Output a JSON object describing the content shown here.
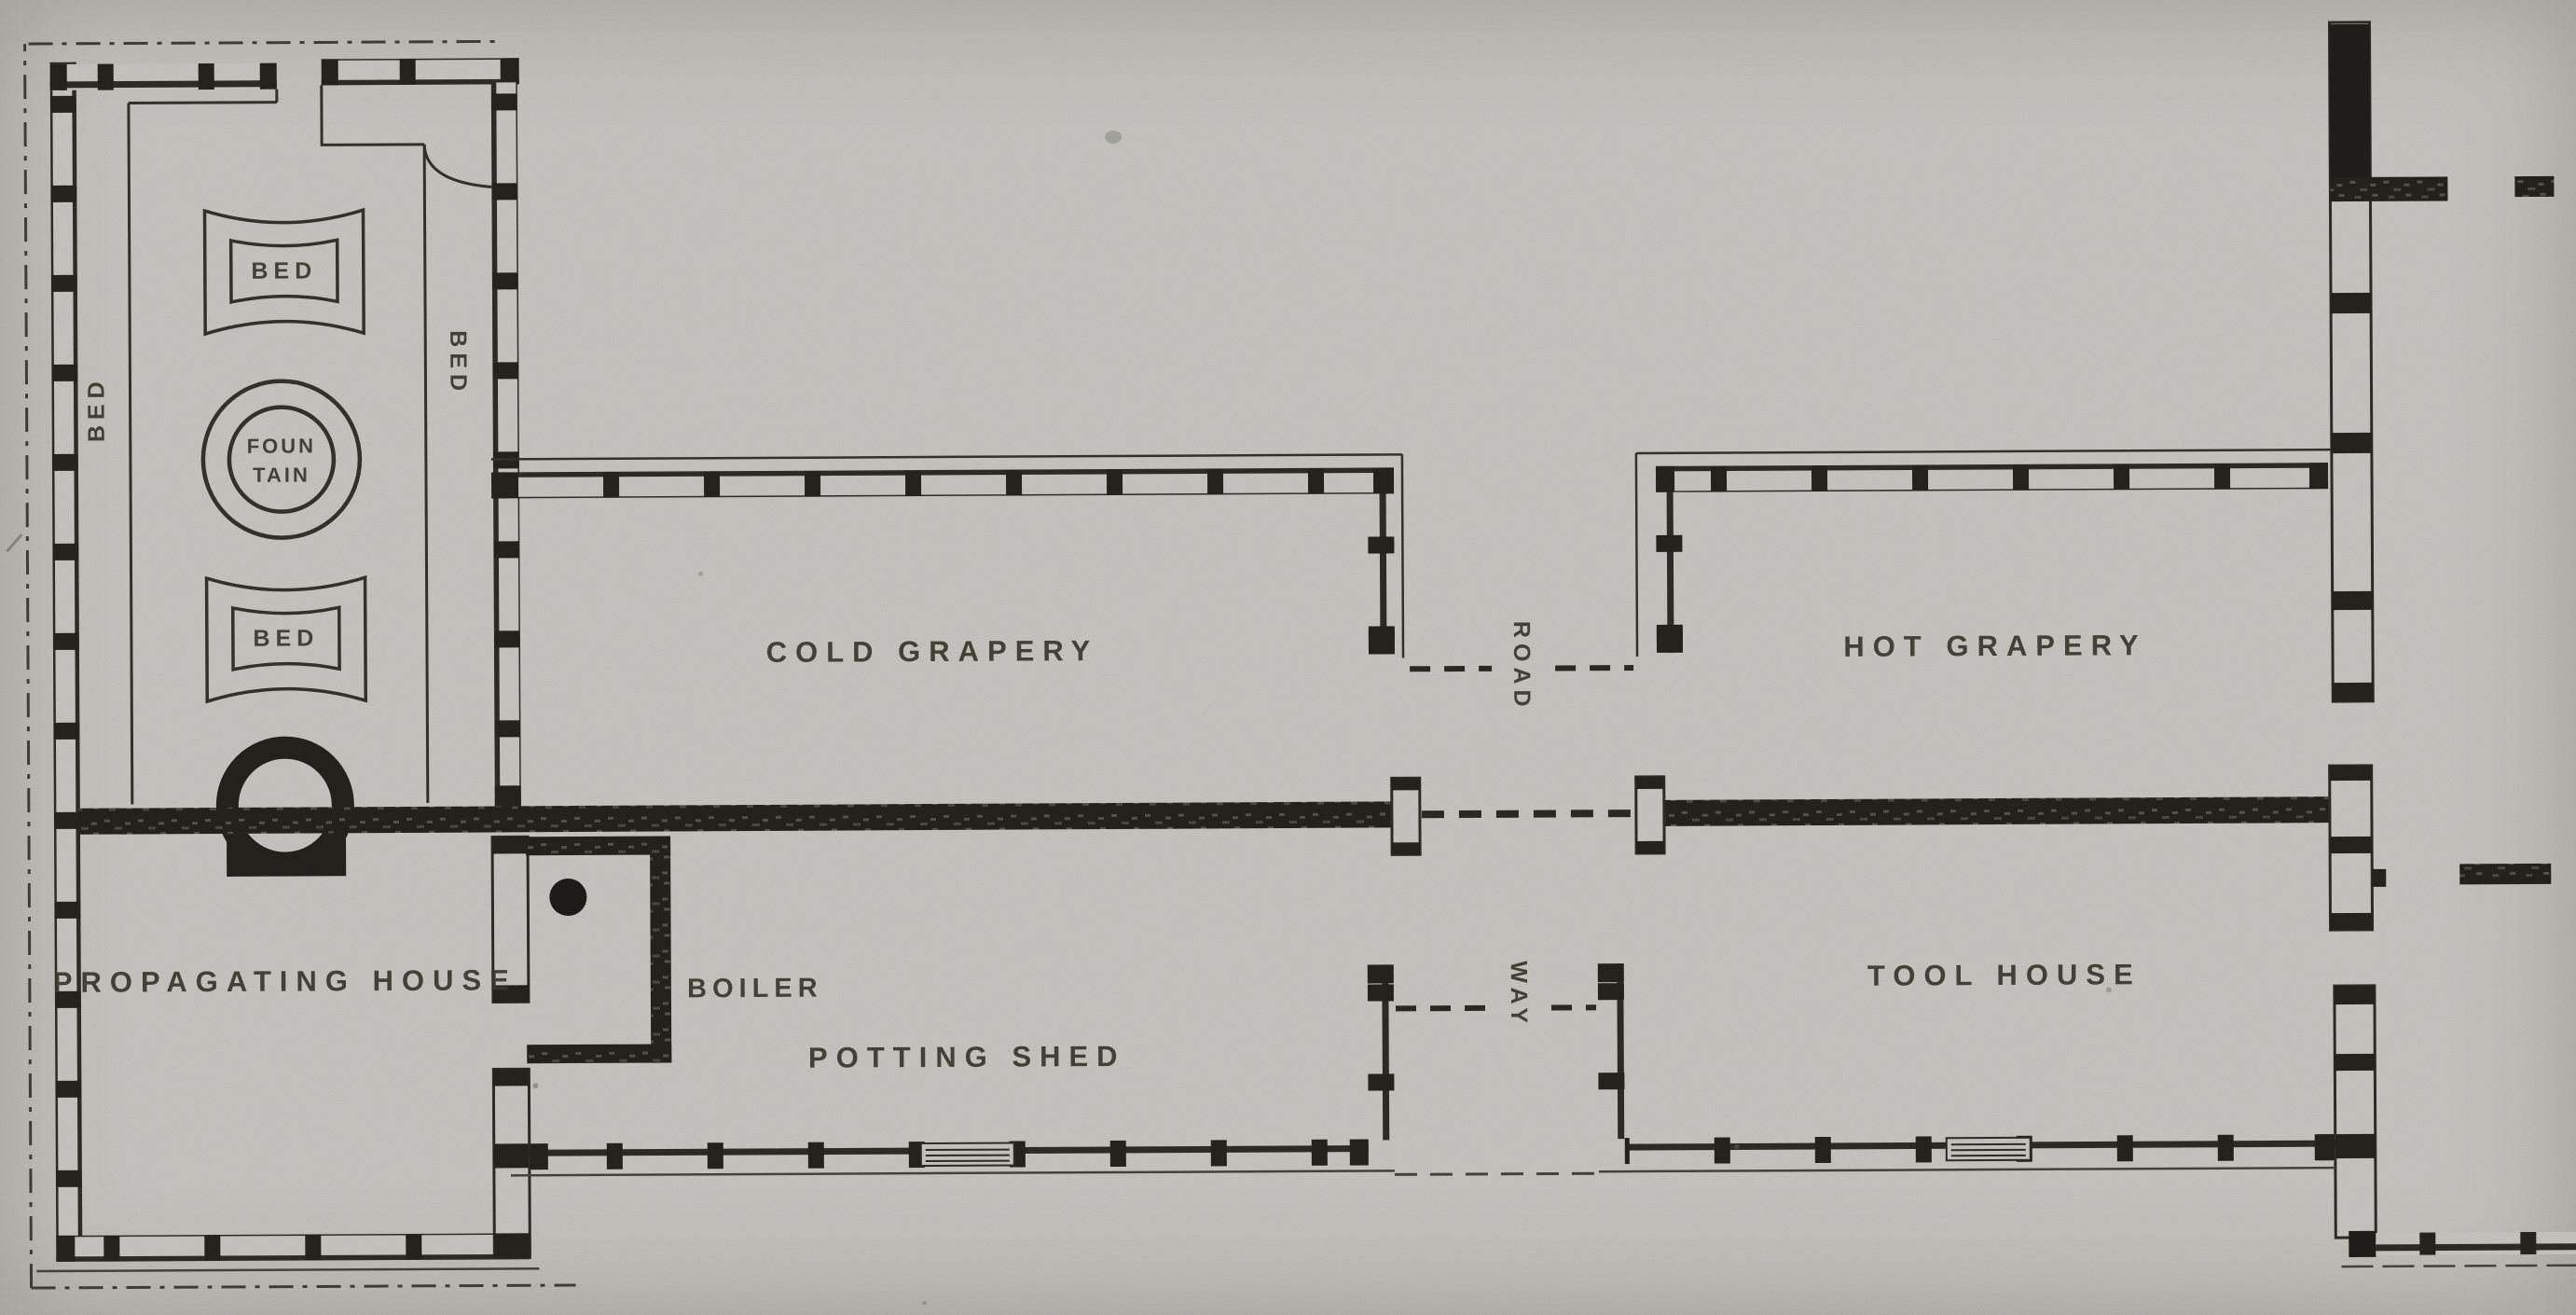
{
  "figure": {
    "type": "scanned-floor-plan",
    "subject": "greenhouse and garden range plan",
    "paper_color": "#c8c7c2",
    "ink_color": "#23231e",
    "label_color": "#39382f"
  },
  "labels": {
    "propagating_house": "PROPAGATING HOUSE",
    "cold_grapery": "COLD GRAPERY",
    "hot_grapery": "HOT GRAPERY",
    "potting_shed": "POTTING SHED",
    "tool_house": "TOOL HOUSE",
    "boiler": "BOILER",
    "road": "ROAD",
    "way": "WAY",
    "bed_left": "BED",
    "bed_middle": "BED",
    "bed_upper": "BED",
    "bed_lower": "BED",
    "fountain_line1": "FOUN",
    "fountain_line2": "TAIN"
  }
}
